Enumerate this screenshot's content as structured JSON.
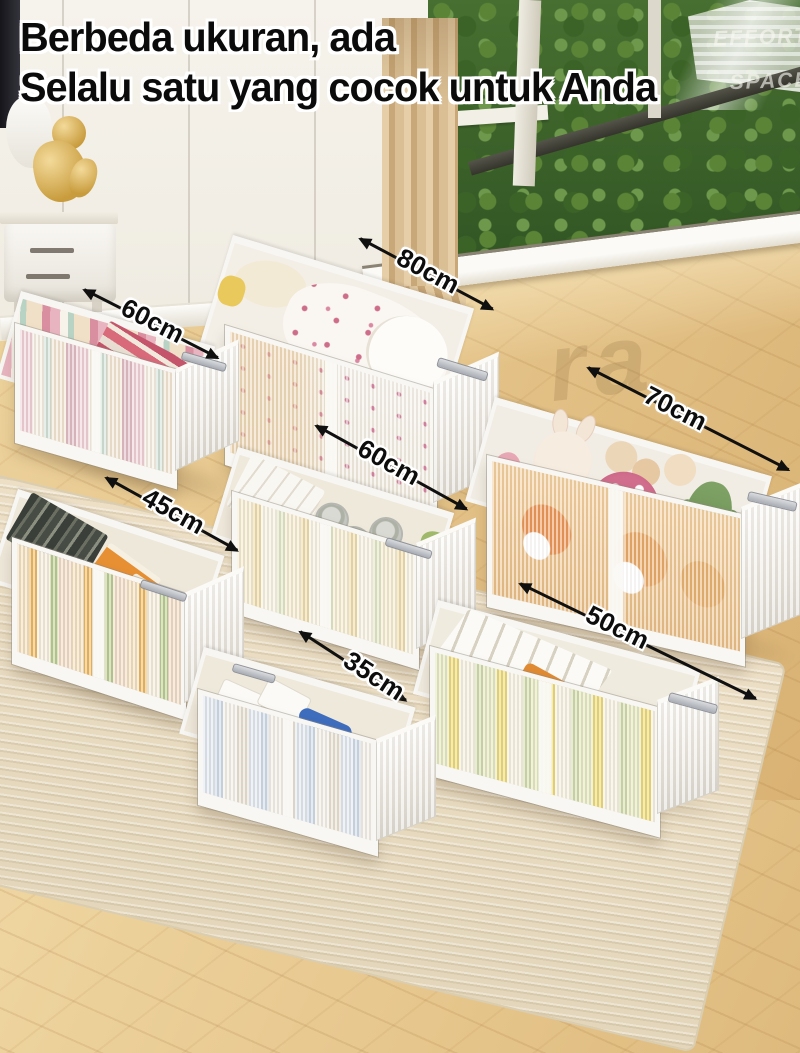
{
  "title": {
    "line1": "Berbeda ukuran, ada",
    "line2": "Selalu satu yang cocok untuk Anda"
  },
  "watermarks": {
    "corner_line1": "EFFORT",
    "corner_line2": "SPACE",
    "floor_text": "ra"
  },
  "boxes": [
    {
      "name": "books",
      "size_label": "60cm",
      "contents": "books and magazines"
    },
    {
      "name": "bedding",
      "size_label": "80cm",
      "contents": "bedding and pillows"
    },
    {
      "name": "plush-toys",
      "size_label": "70cm",
      "contents": "plush toys"
    },
    {
      "name": "canned-snacks",
      "size_label": "60cm",
      "contents": "snack cans and boxes"
    },
    {
      "name": "juice-cartons",
      "size_label": "45cm",
      "contents": "drink cartons"
    },
    {
      "name": "towels",
      "size_label": "35cm",
      "contents": "towels and small boxes"
    },
    {
      "name": "snack-packages",
      "size_label": "50cm",
      "contents": "snack packages"
    }
  ],
  "colors": {
    "headline": "#0b0b0b",
    "headline_outline": "#ffffff",
    "label_text": "#0d0d0d",
    "box_white": "#f6f4ef",
    "handle_gray": "#b9bdc2",
    "floor_wood": "#e5c58d",
    "rug": "#eadfc6",
    "trees_green": "#41662f",
    "curtain": "#d6b88c"
  }
}
